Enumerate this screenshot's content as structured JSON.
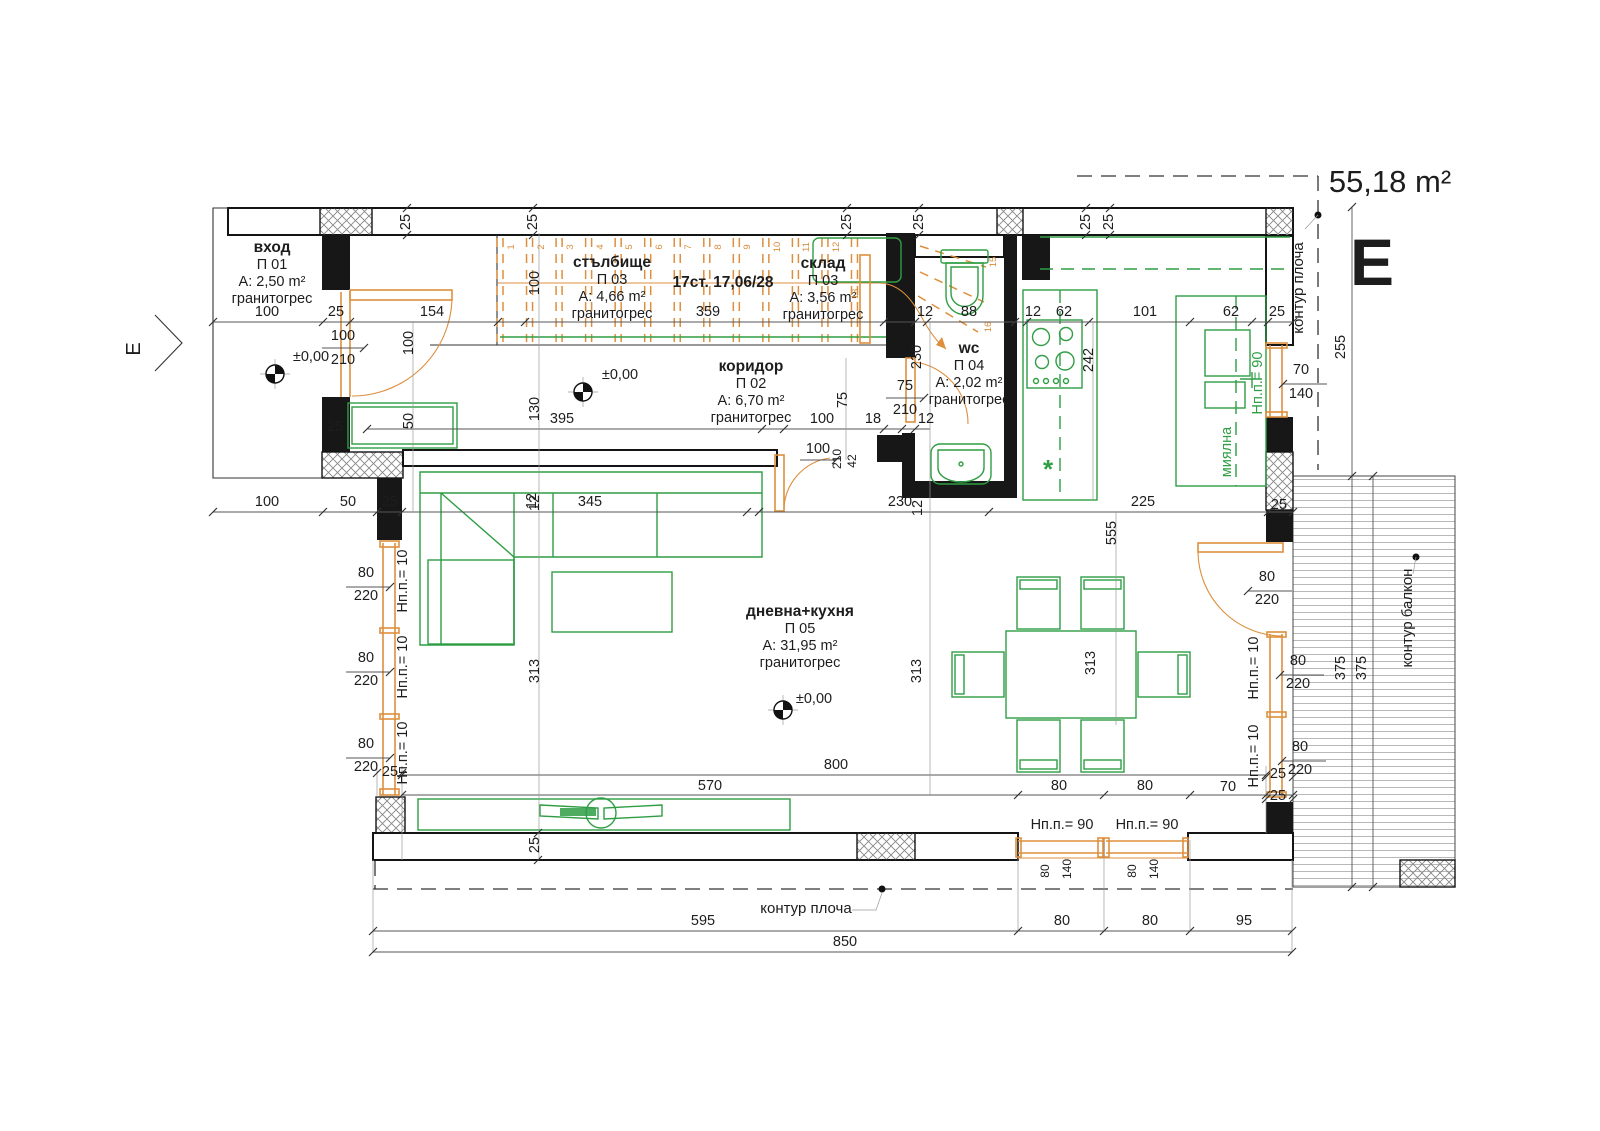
{
  "title": {
    "area": "55,18 m²",
    "section_letter": "E",
    "section_marker": "Е"
  },
  "colors": {
    "wall": "#171717",
    "furniture": "#2f9e44",
    "joinery": "#dd8f3d",
    "dimension": "#1d1d1d"
  },
  "rooms": [
    {
      "name": "вход",
      "id": "П 01",
      "area": "A: 2,50 m²",
      "floor": "гранитогрес",
      "x": 272,
      "y": 252
    },
    {
      "name": "стълбище",
      "id": "П 03",
      "area": "A: 4,66 m²",
      "floor": "гранитогрес",
      "x": 612,
      "y": 267
    },
    {
      "name": "склад",
      "id": "П 03",
      "area": "A: 3,56 m²",
      "floor": "гранитогрес",
      "x": 823,
      "y": 268
    },
    {
      "name": "wc",
      "id": "П 04",
      "area": "A: 2,02 m²",
      "floor": "гранитогрес",
      "x": 969,
      "y": 353
    },
    {
      "name": "коридор",
      "id": "П 02",
      "area": "A: 6,70 m²",
      "floor": "гранитогрес",
      "x": 751,
      "y": 371
    },
    {
      "name": "дневна+кухня",
      "id": "П 05",
      "area": "A: 31,95 m²",
      "floor": "гранитогрес",
      "x": 800,
      "y": 616
    }
  ],
  "stairs": {
    "note": "17ст. 17,06/28",
    "note_x": 723,
    "note_y": 287,
    "numbers": [
      {
        "n": "1",
        "x": 514,
        "y": 247
      },
      {
        "n": "2",
        "x": 544,
        "y": 247
      },
      {
        "n": "3",
        "x": 573,
        "y": 247
      },
      {
        "n": "4",
        "x": 603,
        "y": 247
      },
      {
        "n": "5",
        "x": 632,
        "y": 247
      },
      {
        "n": "6",
        "x": 662,
        "y": 247
      },
      {
        "n": "7",
        "x": 691,
        "y": 247
      },
      {
        "n": "8",
        "x": 721,
        "y": 247
      },
      {
        "n": "9",
        "x": 750,
        "y": 247
      },
      {
        "n": "10",
        "x": 780,
        "y": 247
      },
      {
        "n": "11",
        "x": 809,
        "y": 247
      },
      {
        "n": "12",
        "x": 839,
        "y": 247
      },
      {
        "n": "13",
        "x": 858,
        "y": 294
      },
      {
        "n": "15",
        "x": 996,
        "y": 262
      },
      {
        "n": "16",
        "x": 991,
        "y": 327
      }
    ]
  },
  "labels": [
    {
      "t": "25",
      "x": 410,
      "y": 222,
      "r": -90
    },
    {
      "t": "25",
      "x": 537,
      "y": 222,
      "r": -90
    },
    {
      "t": "25",
      "x": 851,
      "y": 222,
      "r": -90
    },
    {
      "t": "25",
      "x": 923,
      "y": 222,
      "r": -90
    },
    {
      "t": "25",
      "x": 1090,
      "y": 222,
      "r": -90
    },
    {
      "t": "25",
      "x": 1113,
      "y": 222,
      "r": -90
    },
    {
      "t": "100",
      "x": 267,
      "y": 316
    },
    {
      "t": "25",
      "x": 336,
      "y": 316
    },
    {
      "t": "154",
      "x": 432,
      "y": 316
    },
    {
      "t": "359",
      "x": 708,
      "y": 316
    },
    {
      "t": "12",
      "x": 925,
      "y": 316
    },
    {
      "t": "88",
      "x": 969,
      "y": 316
    },
    {
      "t": "12",
      "x": 1033,
      "y": 316
    },
    {
      "t": "62",
      "x": 1064,
      "y": 316
    },
    {
      "t": "101",
      "x": 1145,
      "y": 316
    },
    {
      "t": "62",
      "x": 1231,
      "y": 316
    },
    {
      "t": "25",
      "x": 1277,
      "y": 316
    },
    {
      "t": "100",
      "x": 343,
      "y": 340
    },
    {
      "t": "210",
      "x": 343,
      "y": 364
    },
    {
      "t": "±0,00",
      "x": 311,
      "y": 361,
      "n": "level-mark-entry"
    },
    {
      "t": "±0,00",
      "x": 620,
      "y": 379,
      "n": "level-mark-corridor"
    },
    {
      "t": "±0,00",
      "x": 814,
      "y": 703,
      "n": "level-mark-living"
    },
    {
      "t": "100",
      "x": 413,
      "y": 343,
      "r": -90
    },
    {
      "t": "50",
      "x": 413,
      "y": 421,
      "r": -90
    },
    {
      "t": "25",
      "x": 335,
      "y": 431
    },
    {
      "t": "100",
      "x": 539,
      "y": 283,
      "r": -90
    },
    {
      "t": "130",
      "x": 539,
      "y": 409,
      "r": -90
    },
    {
      "t": "12",
      "x": 539,
      "y": 503,
      "r": -90
    },
    {
      "t": "313",
      "x": 539,
      "y": 671,
      "r": -90
    },
    {
      "t": "25",
      "x": 539,
      "y": 845,
      "r": -90
    },
    {
      "t": "395",
      "x": 562,
      "y": 423
    },
    {
      "t": "100",
      "x": 822,
      "y": 423
    },
    {
      "t": "18",
      "x": 873,
      "y": 423
    },
    {
      "t": "12",
      "x": 926,
      "y": 423
    },
    {
      "t": "100",
      "x": 818,
      "y": 453
    },
    {
      "t": "210",
      "x": 841,
      "y": 459,
      "r": -90,
      "c": "sm"
    },
    {
      "t": "42",
      "x": 856,
      "y": 461,
      "r": -90,
      "c": "sm"
    },
    {
      "t": "75",
      "x": 847,
      "y": 400,
      "r": -90
    },
    {
      "t": "75",
      "x": 905,
      "y": 390
    },
    {
      "t": "210",
      "x": 905,
      "y": 414
    },
    {
      "t": "230",
      "x": 921,
      "y": 357,
      "r": -90
    },
    {
      "t": "100",
      "x": 267,
      "y": 506
    },
    {
      "t": "50",
      "x": 348,
      "y": 506
    },
    {
      "t": "25",
      "x": 390,
      "y": 506
    },
    {
      "t": "345",
      "x": 590,
      "y": 506
    },
    {
      "t": "12",
      "x": 536,
      "y": 501,
      "r": -90
    },
    {
      "t": "230",
      "x": 900,
      "y": 506
    },
    {
      "t": "12",
      "x": 922,
      "y": 508,
      "r": -90
    },
    {
      "t": "225",
      "x": 1143,
      "y": 506
    },
    {
      "t": "25",
      "x": 1279,
      "y": 509
    },
    {
      "t": "242",
      "x": 1093,
      "y": 360,
      "r": -90
    },
    {
      "t": "555",
      "x": 1116,
      "y": 533,
      "r": -90
    },
    {
      "t": "313",
      "x": 921,
      "y": 671,
      "r": -90
    },
    {
      "t": "313",
      "x": 1095,
      "y": 663,
      "r": -90
    },
    {
      "t": "70",
      "x": 1301,
      "y": 374
    },
    {
      "t": "140",
      "x": 1301,
      "y": 398
    },
    {
      "t": "255",
      "x": 1345,
      "y": 347,
      "r": -90
    },
    {
      "t": "Нп.п.= 90",
      "x": 1262,
      "y": 383,
      "r": -90,
      "c": "green"
    },
    {
      "t": "миялна",
      "x": 1231,
      "y": 452,
      "r": -90,
      "c": "green",
      "n": "sink-label"
    },
    {
      "t": "80",
      "x": 366,
      "y": 577
    },
    {
      "t": "220",
      "x": 366,
      "y": 600
    },
    {
      "t": "80",
      "x": 366,
      "y": 662
    },
    {
      "t": "220",
      "x": 366,
      "y": 685
    },
    {
      "t": "80",
      "x": 366,
      "y": 748
    },
    {
      "t": "220",
      "x": 366,
      "y": 771
    },
    {
      "t": "Нп.п.= 10",
      "x": 407,
      "y": 581,
      "r": -90
    },
    {
      "t": "Нп.п.= 10",
      "x": 407,
      "y": 667,
      "r": -90
    },
    {
      "t": "Нп.п.= 10",
      "x": 407,
      "y": 753,
      "r": -90
    },
    {
      "t": "Нп.п.= 10",
      "x": 1258,
      "y": 668,
      "r": -90
    },
    {
      "t": "Нп.п.= 10",
      "x": 1258,
      "y": 756,
      "r": -90
    },
    {
      "t": "80",
      "x": 1267,
      "y": 581
    },
    {
      "t": "220",
      "x": 1267,
      "y": 604
    },
    {
      "t": "80",
      "x": 1298,
      "y": 665
    },
    {
      "t": "220",
      "x": 1298,
      "y": 688
    },
    {
      "t": "80",
      "x": 1300,
      "y": 751
    },
    {
      "t": "220",
      "x": 1300,
      "y": 774
    },
    {
      "t": "25",
      "x": 1278,
      "y": 778
    },
    {
      "t": "25",
      "x": 1278,
      "y": 800
    },
    {
      "t": "70",
      "x": 1228,
      "y": 791
    },
    {
      "t": "800",
      "x": 836,
      "y": 769
    },
    {
      "t": "570",
      "x": 710,
      "y": 790
    },
    {
      "t": "80",
      "x": 1059,
      "y": 790
    },
    {
      "t": "80",
      "x": 1145,
      "y": 790
    },
    {
      "t": "Нп.п.= 90",
      "x": 1062,
      "y": 829
    },
    {
      "t": "Нп.п.= 90",
      "x": 1147,
      "y": 829
    },
    {
      "t": "80",
      "x": 1049,
      "y": 871,
      "r": -90,
      "c": "sm"
    },
    {
      "t": "140",
      "x": 1071,
      "y": 869,
      "r": -90,
      "c": "sm"
    },
    {
      "t": "80",
      "x": 1136,
      "y": 871,
      "r": -90,
      "c": "sm"
    },
    {
      "t": "140",
      "x": 1158,
      "y": 869,
      "r": -90,
      "c": "sm"
    },
    {
      "t": "контур плоча",
      "x": 806,
      "y": 913,
      "c": "kontur",
      "n": "slab-contour-label"
    },
    {
      "t": "595",
      "x": 703,
      "y": 925
    },
    {
      "t": "80",
      "x": 1062,
      "y": 925
    },
    {
      "t": "80",
      "x": 1150,
      "y": 925
    },
    {
      "t": "95",
      "x": 1244,
      "y": 925
    },
    {
      "t": "850",
      "x": 845,
      "y": 946
    },
    {
      "t": "375",
      "x": 1345,
      "y": 668,
      "r": -90
    },
    {
      "t": "375",
      "x": 1366,
      "y": 668,
      "r": -90
    },
    {
      "t": "25",
      "x": 390,
      "y": 776
    },
    {
      "t": "контур плоча",
      "x": 1303,
      "y": 288,
      "r": -90,
      "c": "kontur",
      "n": "slab-contour-label"
    },
    {
      "t": "контур балкон",
      "x": 1412,
      "y": 618,
      "r": -90,
      "c": "kontur",
      "n": "balcony-contour-label"
    },
    {
      "t": "*",
      "x": 1048,
      "y": 478,
      "c": "greenbig",
      "n": "dishwasher-mark"
    },
    {
      "t": "Е",
      "x": 140,
      "y": 349,
      "r": -90,
      "c": "section-e",
      "n": "section-marker-letter"
    }
  ]
}
